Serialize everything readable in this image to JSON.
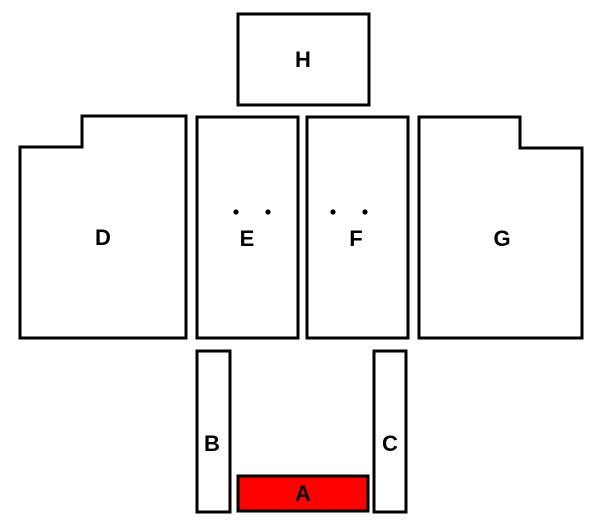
{
  "diagram": {
    "background": "#ffffff",
    "outline_color": "#000000",
    "label_color": "#000000",
    "highlight_color": "#ff0000",
    "stroke_width": 3,
    "dot_radius": 2.6,
    "label_font_size": 22,
    "regions": [
      {
        "id": "H",
        "label": "H",
        "shape": "rect",
        "x": 238,
        "y": 14,
        "w": 131,
        "h": 91,
        "fill": "#ffffff",
        "label_x": 303,
        "label_y": 67
      },
      {
        "id": "D",
        "label": "D",
        "shape": "polygon",
        "points": "20,147 82,147 82,116 186,116 186,338 20,338",
        "fill": "#ffffff",
        "label_x": 103,
        "label_y": 245
      },
      {
        "id": "E",
        "label": "E",
        "shape": "rect",
        "x": 197,
        "y": 117,
        "w": 101,
        "h": 221,
        "fill": "#ffffff",
        "label_x": 247,
        "label_y": 246,
        "dots": [
          [
            236,
            212
          ],
          [
            268,
            212
          ]
        ]
      },
      {
        "id": "F",
        "label": "F",
        "shape": "rect",
        "x": 307,
        "y": 117,
        "w": 101,
        "h": 221,
        "fill": "#ffffff",
        "label_x": 356,
        "label_y": 246,
        "dots": [
          [
            333,
            212
          ],
          [
            365,
            212
          ]
        ]
      },
      {
        "id": "G",
        "label": "G",
        "shape": "polygon",
        "points": "419,117 520,117 520,148 582,148 582,338 419,338",
        "fill": "#ffffff",
        "label_x": 502,
        "label_y": 246
      },
      {
        "id": "B",
        "label": "B",
        "shape": "rect",
        "x": 197,
        "y": 351,
        "w": 33,
        "h": 161,
        "fill": "#ffffff",
        "label_x": 212,
        "label_y": 451
      },
      {
        "id": "C",
        "label": "C",
        "shape": "rect",
        "x": 374,
        "y": 351,
        "w": 32,
        "h": 161,
        "fill": "#ffffff",
        "label_x": 390,
        "label_y": 451
      },
      {
        "id": "A",
        "label": "A",
        "shape": "rect",
        "x": 238,
        "y": 476,
        "w": 130,
        "h": 35,
        "fill": "#ff0000",
        "label_x": 303,
        "label_y": 501
      }
    ]
  }
}
